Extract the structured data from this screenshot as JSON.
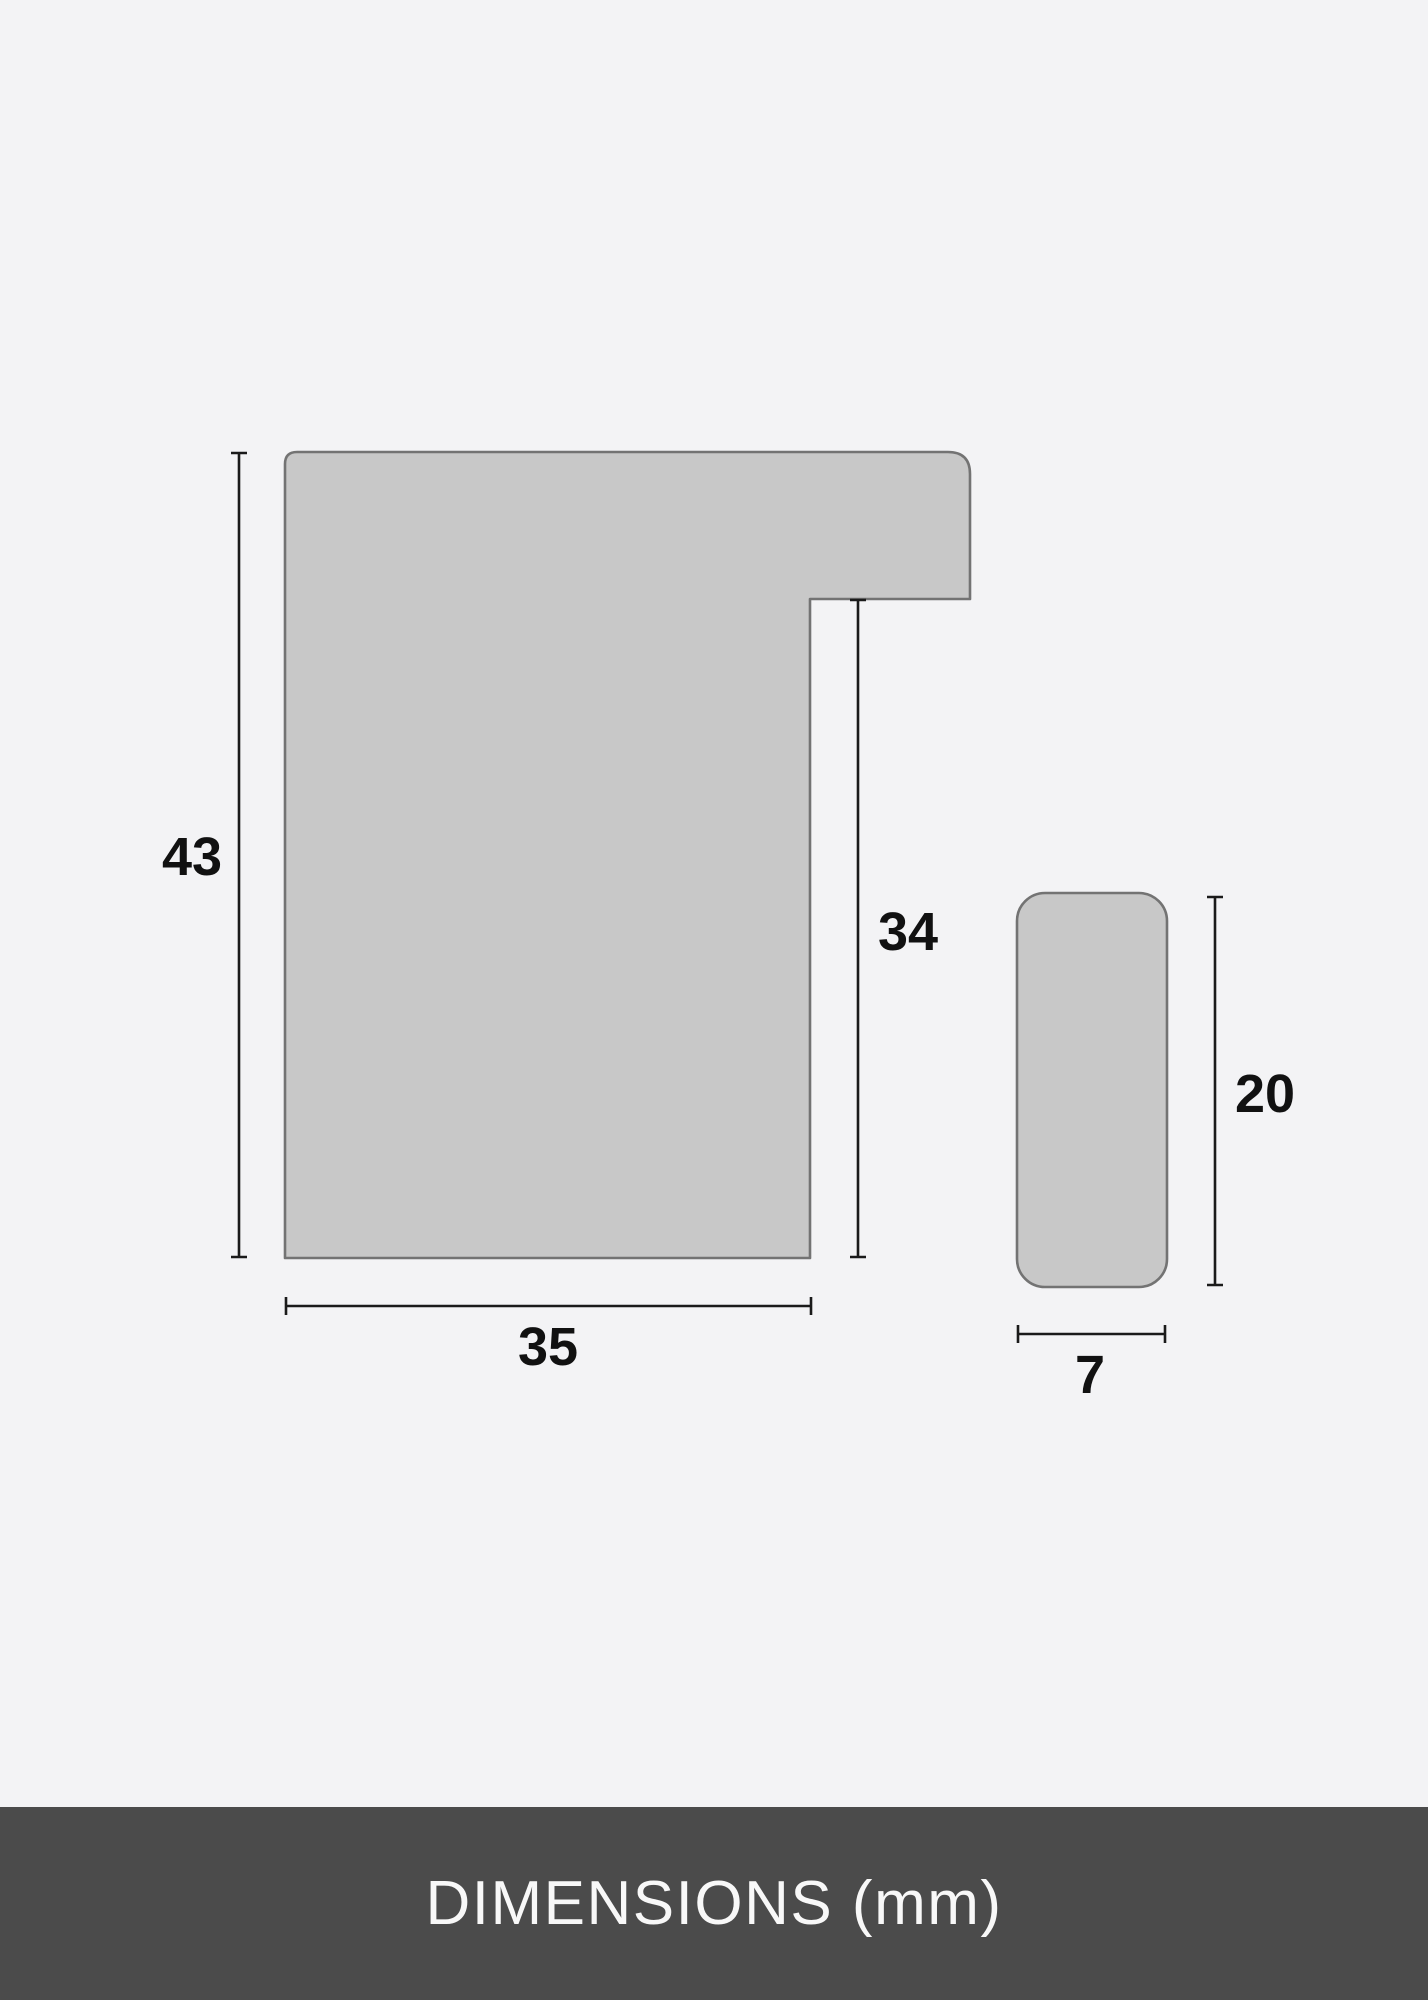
{
  "colors": {
    "page-bg": "#f3f3f5",
    "shape-fill": "#c8c8c8",
    "shape-stroke": "#737373",
    "dim-line": "#1a1a1a",
    "label-text": "#111111",
    "footer-bg": "#4b4b4b",
    "footer-text": "#f8f8f8"
  },
  "diagram": {
    "labels": {
      "profile_height": "43",
      "profile_width": "35",
      "rabbet_depth": "34",
      "spacer_height": "20",
      "spacer_width": "7"
    }
  },
  "footer": {
    "title": "DIMENSIONS (mm)"
  }
}
